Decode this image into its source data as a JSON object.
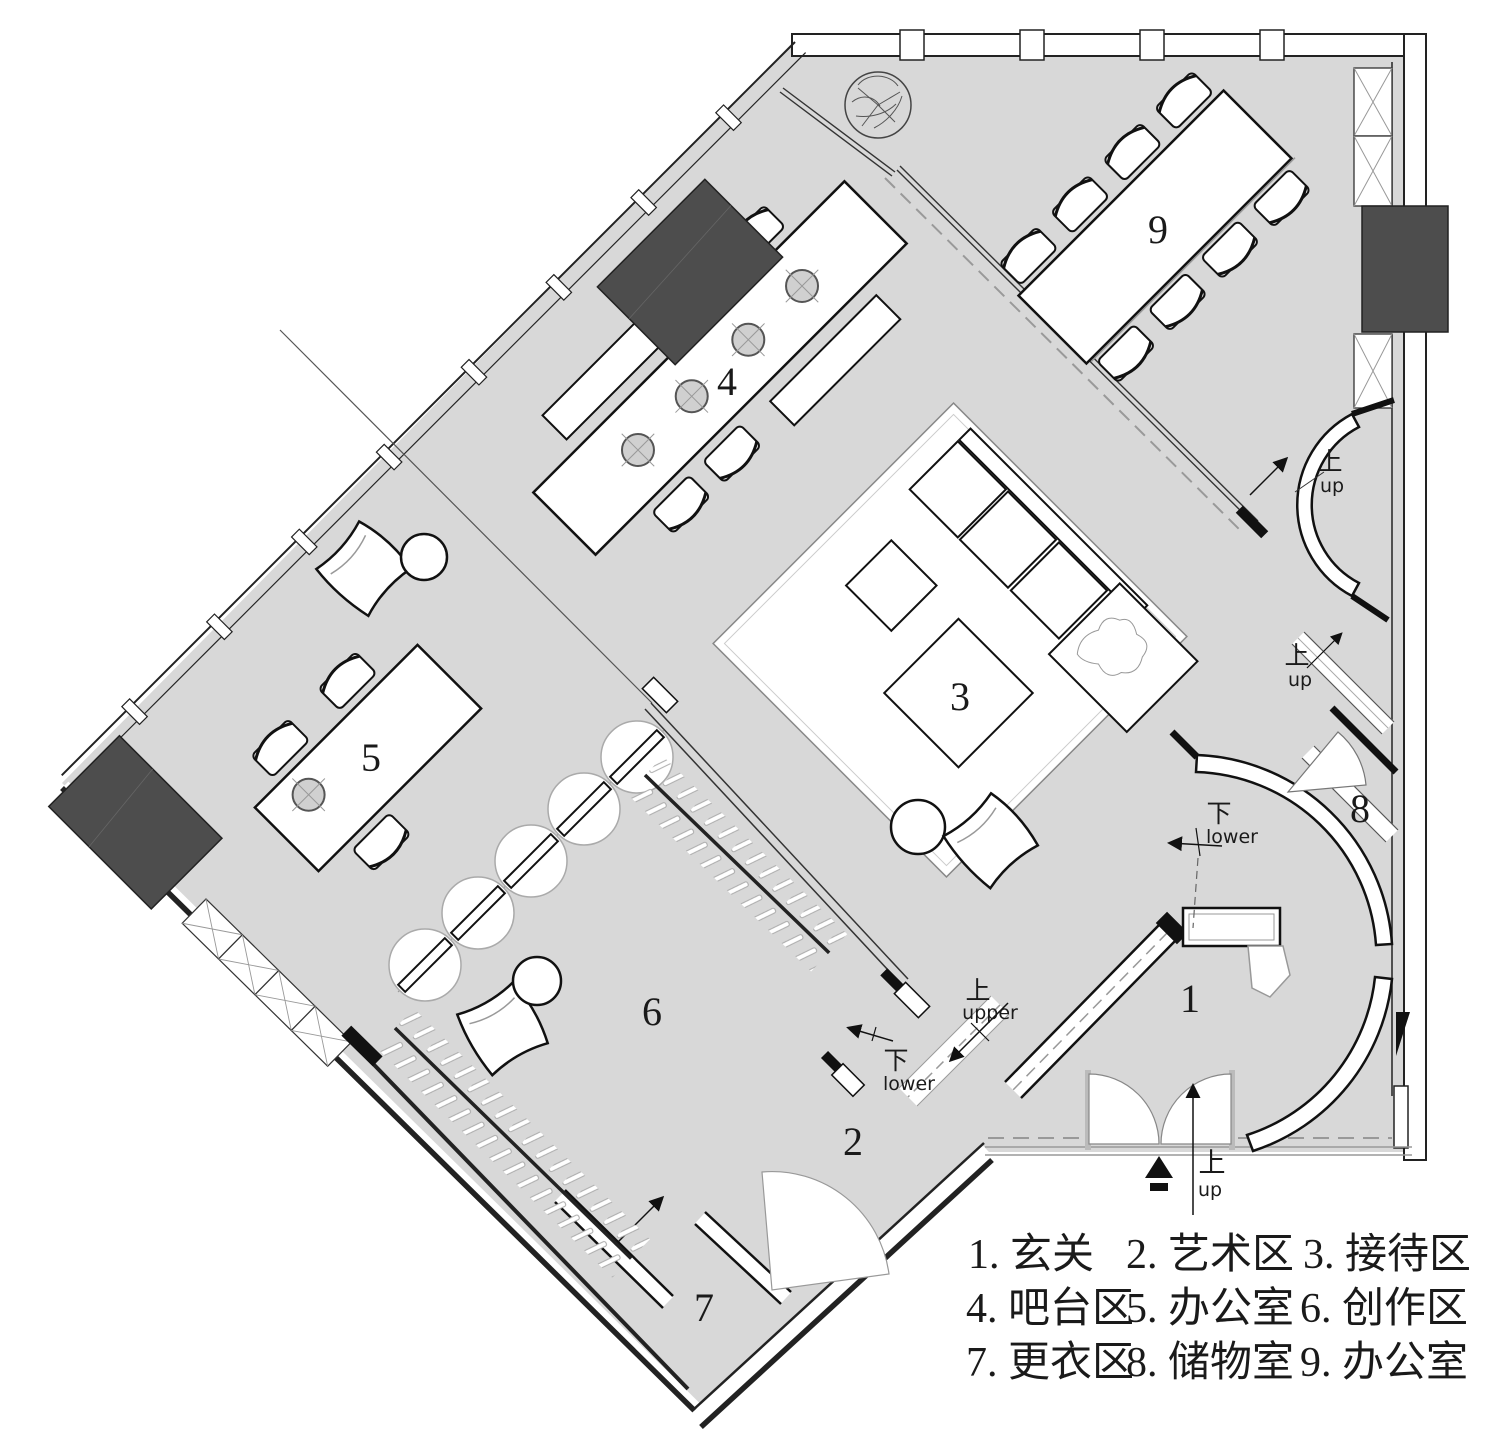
{
  "legend": {
    "items": [
      {
        "text": "1. 玄关"
      },
      {
        "text": "2. 艺术区"
      },
      {
        "text": "3. 接待区"
      },
      {
        "text": "4. 吧台区"
      },
      {
        "text": "5. 办公室"
      },
      {
        "text": "6. 创作区"
      },
      {
        "text": "7. 更衣区"
      },
      {
        "text": "8. 储物室"
      },
      {
        "text": "9. 办公室"
      }
    ]
  },
  "rooms": {
    "r1": "1",
    "r2": "2",
    "r3": "3",
    "r4": "4",
    "r5": "5",
    "r6": "6",
    "r7": "7",
    "r8": "8",
    "r9": "9"
  },
  "annotations": {
    "up_cn": "上",
    "up_en": "up",
    "down_cn": "下",
    "lower_en": "lower",
    "upper_en": "upper"
  },
  "colors": {
    "floor": "#d8d8d8",
    "wall": "#1a1a1a",
    "column": "#4d4d4d",
    "dash": "#999999",
    "paper": "#ffffff"
  }
}
